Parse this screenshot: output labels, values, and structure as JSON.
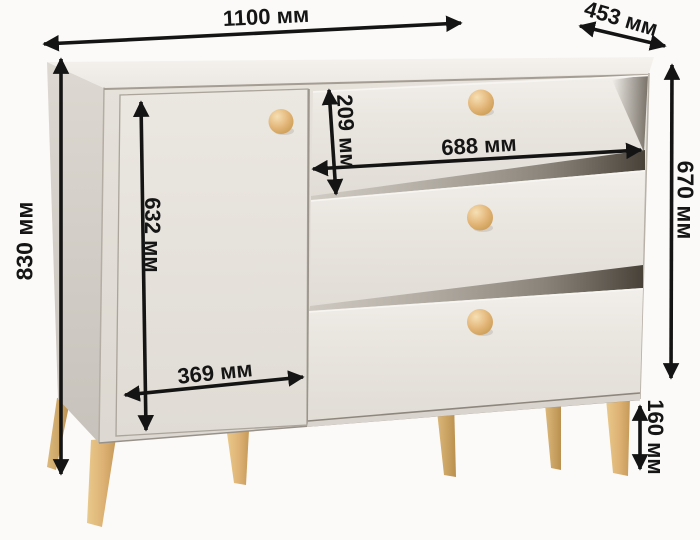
{
  "diagram": {
    "type": "furniture-dimension-diagram",
    "unit": "мм"
  },
  "dimensions": {
    "width": {
      "label": "1100 мм",
      "value": 1100,
      "unit": "мм"
    },
    "depth": {
      "label": "453 мм",
      "value": 453,
      "unit": "мм"
    },
    "height": {
      "label": "830 мм",
      "value": 830,
      "unit": "мм"
    },
    "door_height": {
      "label": "632 мм",
      "value": 632,
      "unit": "мм"
    },
    "door_width": {
      "label": "369 мм",
      "value": 369,
      "unit": "мм"
    },
    "drawer_height": {
      "label": "209 мм",
      "value": 209,
      "unit": "мм"
    },
    "drawer_width": {
      "label": "688 мм",
      "value": 688,
      "unit": "мм"
    },
    "body_height": {
      "label": "670 мм",
      "value": 670,
      "unit": "мм"
    },
    "leg_height": {
      "label": "160 мм",
      "value": 160,
      "unit": "мм"
    }
  },
  "colors": {
    "background": "#fbfaf8",
    "dimension_line": "#141414",
    "body_front": "#e7e3dc",
    "body_side": "#cfcac3",
    "body_top": "#f2efeb",
    "knob_wood": "#e2b577",
    "leg_wood": "#dcb476"
  }
}
